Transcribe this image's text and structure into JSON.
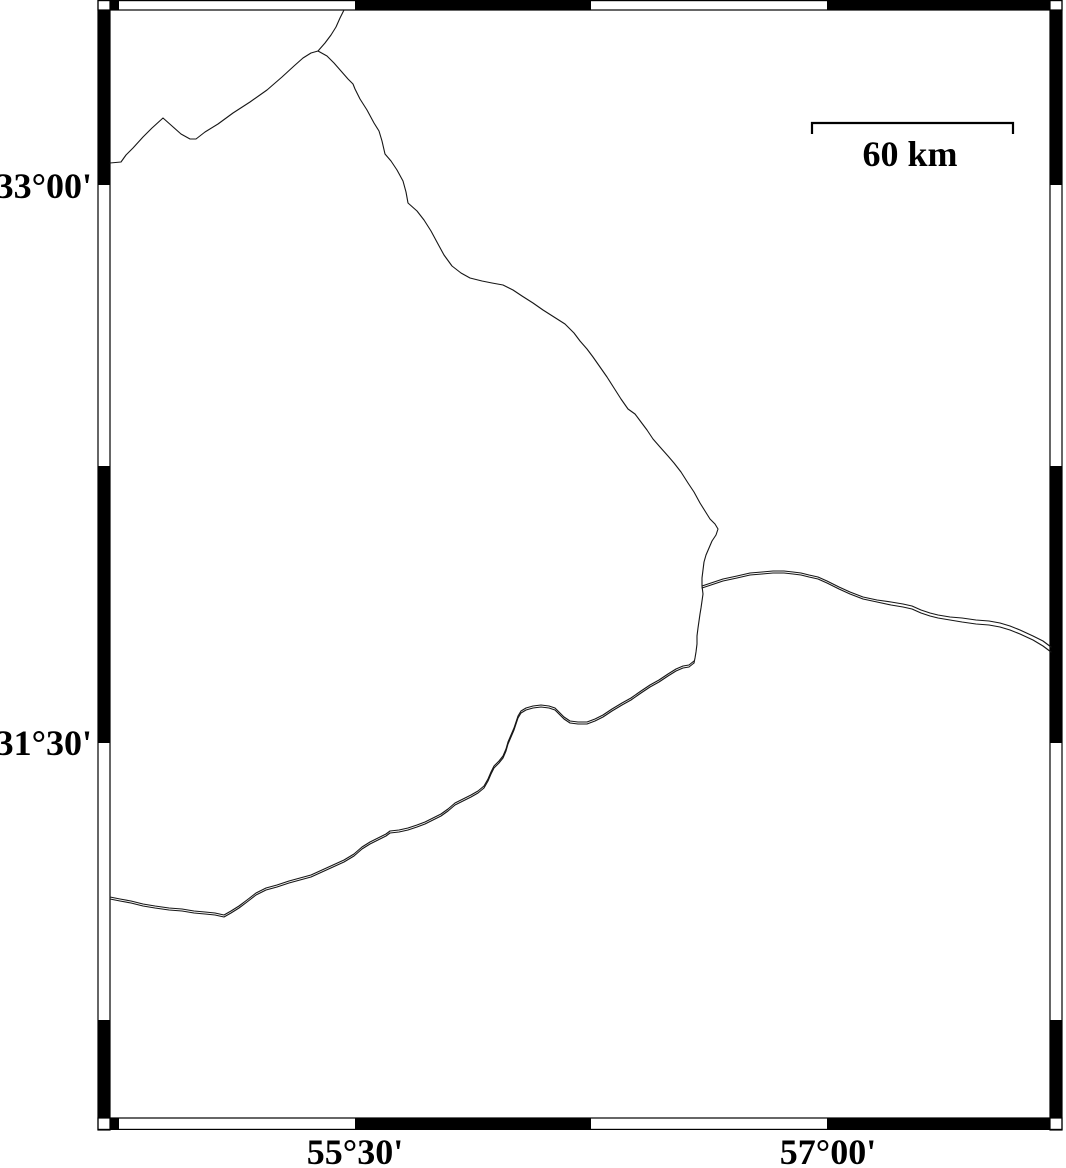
{
  "map": {
    "background": "#ffffff",
    "line_color": "#161616",
    "frame_color": "#000000",
    "plot_area": {
      "x0": 110,
      "y0": 10,
      "x1": 1050,
      "y1": 1118
    },
    "outer_frame": {
      "x0": 98,
      "y0": 0,
      "x1": 1062,
      "y1": 1130
    },
    "axes": {
      "left_labels": [
        {
          "text": "33°00'",
          "y": 185
        },
        {
          "text": "31°30'",
          "y": 742
        }
      ],
      "bottom_labels": [
        {
          "text": "55°30'",
          "x": 355
        },
        {
          "text": "57°00'",
          "x": 828
        }
      ]
    },
    "frame_segments": {
      "top_black_x": [
        [
          110,
          119
        ],
        [
          355,
          591
        ],
        [
          827,
          1050
        ]
      ],
      "bottom_black_x": [
        [
          110,
          119
        ],
        [
          355,
          591
        ],
        [
          827,
          1050
        ]
      ],
      "left_black_y": [
        [
          10,
          185
        ],
        [
          466,
          743
        ],
        [
          1020,
          1118
        ]
      ],
      "right_black_y": [
        [
          10,
          185
        ],
        [
          466,
          743
        ],
        [
          1020,
          1118
        ]
      ],
      "corner_cells": [
        [
          98,
          0,
          110,
          10
        ],
        [
          1050,
          0,
          1062,
          10
        ],
        [
          98,
          1118,
          110,
          1130
        ],
        [
          1050,
          1118,
          1062,
          1130
        ]
      ]
    },
    "scale_bar": {
      "label": "60 km",
      "x1": 812,
      "x2": 1013,
      "y": 123,
      "tick_drop": 11,
      "label_x": 910,
      "label_y": 166
    },
    "lines": [
      {
        "name": "boundary-northwest",
        "points": [
          [
            110,
            163
          ],
          [
            121,
            162
          ],
          [
            126,
            155
          ],
          [
            133,
            148
          ],
          [
            143,
            137
          ],
          [
            152,
            128
          ],
          [
            163,
            118
          ],
          [
            172,
            126
          ],
          [
            181,
            134
          ],
          [
            190,
            139
          ],
          [
            196,
            139
          ],
          [
            205,
            132
          ],
          [
            218,
            124
          ],
          [
            233,
            113
          ],
          [
            250,
            102
          ],
          [
            267,
            90
          ],
          [
            282,
            77
          ],
          [
            294,
            66
          ],
          [
            303,
            58
          ],
          [
            311,
            53
          ],
          [
            318,
            51
          ],
          [
            327,
            56
          ],
          [
            334,
            63
          ],
          [
            341,
            71
          ],
          [
            348,
            79
          ],
          [
            353,
            84
          ],
          [
            355,
            89
          ],
          [
            360,
            99
          ],
          [
            367,
            110
          ],
          [
            374,
            123
          ],
          [
            379,
            131
          ],
          [
            382,
            141
          ],
          [
            385,
            154
          ],
          [
            391,
            161
          ],
          [
            397,
            170
          ],
          [
            403,
            181
          ],
          [
            406,
            192
          ],
          [
            408,
            203
          ],
          [
            417,
            211
          ],
          [
            424,
            220
          ],
          [
            431,
            231
          ],
          [
            438,
            244
          ],
          [
            444,
            255
          ],
          [
            452,
            266
          ],
          [
            461,
            273
          ],
          [
            470,
            278
          ],
          [
            482,
            281
          ],
          [
            492,
            283
          ],
          [
            503,
            285
          ],
          [
            513,
            290
          ],
          [
            522,
            296
          ],
          [
            533,
            303
          ],
          [
            543,
            310
          ],
          [
            554,
            317
          ],
          [
            565,
            324
          ],
          [
            574,
            333
          ],
          [
            580,
            341
          ],
          [
            587,
            349
          ],
          [
            593,
            357
          ],
          [
            600,
            367
          ],
          [
            607,
            377
          ],
          [
            614,
            388
          ],
          [
            621,
            399
          ],
          [
            628,
            409
          ],
          [
            635,
            414
          ],
          [
            641,
            422
          ],
          [
            647,
            430
          ],
          [
            653,
            439
          ],
          [
            660,
            447
          ],
          [
            668,
            456
          ],
          [
            674,
            463
          ],
          [
            681,
            472
          ],
          [
            688,
            483
          ],
          [
            694,
            492
          ],
          [
            700,
            503
          ],
          [
            705,
            511
          ],
          [
            710,
            519
          ],
          [
            715,
            524
          ],
          [
            718,
            529
          ],
          [
            716,
            535
          ],
          [
            712,
            541
          ],
          [
            709,
            548
          ],
          [
            706,
            555
          ],
          [
            704,
            562
          ],
          [
            703,
            570
          ],
          [
            702,
            578
          ],
          [
            702,
            586
          ],
          [
            703,
            594
          ],
          [
            702,
            601
          ],
          [
            701,
            608
          ],
          [
            700,
            614
          ],
          [
            699,
            621
          ],
          [
            698,
            628
          ],
          [
            697,
            636
          ],
          [
            697,
            644
          ],
          [
            696,
            652
          ],
          [
            695,
            658
          ],
          [
            694,
            663
          ]
        ]
      },
      {
        "name": "boundary-north-spur",
        "points": [
          [
            318,
            51
          ],
          [
            325,
            43
          ],
          [
            331,
            35
          ],
          [
            336,
            27
          ],
          [
            340,
            18
          ],
          [
            344,
            10
          ]
        ]
      },
      {
        "name": "boundary-east-upper",
        "points": [
          [
            702,
            586
          ],
          [
            711,
            583
          ],
          [
            723,
            579
          ],
          [
            737,
            576
          ],
          [
            750,
            573
          ],
          [
            762,
            572
          ],
          [
            773,
            571
          ],
          [
            784,
            571
          ],
          [
            793,
            572
          ],
          [
            801,
            573
          ],
          [
            809,
            575
          ],
          [
            818,
            577
          ],
          [
            827,
            581
          ],
          [
            839,
            587
          ],
          [
            850,
            592
          ],
          [
            863,
            597
          ],
          [
            877,
            600
          ],
          [
            891,
            602
          ],
          [
            903,
            604
          ],
          [
            912,
            606
          ],
          [
            921,
            610
          ],
          [
            930,
            613
          ],
          [
            938,
            615
          ],
          [
            950,
            617
          ],
          [
            962,
            618
          ],
          [
            976,
            620
          ],
          [
            989,
            621
          ],
          [
            1000,
            623
          ],
          [
            1010,
            626
          ],
          [
            1020,
            630
          ],
          [
            1033,
            636
          ],
          [
            1043,
            641
          ],
          [
            1051,
            647
          ]
        ]
      },
      {
        "name": "boundary-east-lower",
        "points": [
          [
            702,
            588
          ],
          [
            711,
            585
          ],
          [
            723,
            581
          ],
          [
            737,
            578
          ],
          [
            750,
            575
          ],
          [
            762,
            574
          ],
          [
            773,
            573
          ],
          [
            784,
            573
          ],
          [
            793,
            574
          ],
          [
            801,
            575
          ],
          [
            809,
            577
          ],
          [
            818,
            579
          ],
          [
            827,
            583
          ],
          [
            839,
            589
          ],
          [
            850,
            594
          ],
          [
            863,
            599
          ],
          [
            877,
            602
          ],
          [
            891,
            605
          ],
          [
            903,
            607
          ],
          [
            912,
            609
          ],
          [
            921,
            613
          ],
          [
            930,
            616
          ],
          [
            938,
            618
          ],
          [
            950,
            620
          ],
          [
            962,
            622
          ],
          [
            976,
            624
          ],
          [
            989,
            625
          ],
          [
            1000,
            627
          ],
          [
            1010,
            630
          ],
          [
            1020,
            634
          ],
          [
            1033,
            640
          ],
          [
            1043,
            646
          ],
          [
            1051,
            652
          ]
        ]
      },
      {
        "name": "boundary-southwest",
        "offset_copy": [
          0,
          -2
        ],
        "points": [
          [
            694,
            663
          ],
          [
            689,
            667
          ],
          [
            683,
            668
          ],
          [
            676,
            671
          ],
          [
            668,
            676
          ],
          [
            659,
            682
          ],
          [
            650,
            687
          ],
          [
            641,
            693
          ],
          [
            631,
            700
          ],
          [
            622,
            705
          ],
          [
            612,
            711
          ],
          [
            603,
            717
          ],
          [
            595,
            721
          ],
          [
            587,
            724
          ],
          [
            578,
            724
          ],
          [
            570,
            723
          ],
          [
            564,
            719
          ],
          [
            559,
            714
          ],
          [
            555,
            710
          ],
          [
            549,
            708
          ],
          [
            541,
            707
          ],
          [
            533,
            708
          ],
          [
            526,
            710
          ],
          [
            521,
            713
          ],
          [
            518,
            718
          ],
          [
            516,
            724
          ],
          [
            514,
            730
          ],
          [
            511,
            737
          ],
          [
            508,
            744
          ],
          [
            506,
            751
          ],
          [
            503,
            758
          ],
          [
            499,
            763
          ],
          [
            494,
            768
          ],
          [
            491,
            774
          ],
          [
            488,
            781
          ],
          [
            484,
            788
          ],
          [
            478,
            793
          ],
          [
            471,
            797
          ],
          [
            463,
            801
          ],
          [
            455,
            805
          ],
          [
            448,
            811
          ],
          [
            441,
            816
          ],
          [
            433,
            820
          ],
          [
            425,
            824
          ],
          [
            417,
            827
          ],
          [
            408,
            830
          ],
          [
            399,
            832
          ],
          [
            390,
            833
          ],
          [
            386,
            836
          ],
          [
            378,
            840
          ],
          [
            370,
            844
          ],
          [
            362,
            849
          ],
          [
            354,
            856
          ],
          [
            344,
            862
          ],
          [
            333,
            867
          ],
          [
            322,
            872
          ],
          [
            311,
            877
          ],
          [
            300,
            880
          ],
          [
            289,
            883
          ],
          [
            277,
            887
          ],
          [
            266,
            890
          ],
          [
            256,
            895
          ],
          [
            247,
            902
          ],
          [
            239,
            908
          ],
          [
            231,
            913
          ],
          [
            224,
            917
          ],
          [
            215,
            915
          ],
          [
            205,
            914
          ],
          [
            194,
            913
          ],
          [
            182,
            911
          ],
          [
            169,
            910
          ],
          [
            155,
            908
          ],
          [
            143,
            906
          ],
          [
            131,
            903
          ],
          [
            120,
            901
          ],
          [
            110,
            899
          ]
        ]
      }
    ]
  }
}
